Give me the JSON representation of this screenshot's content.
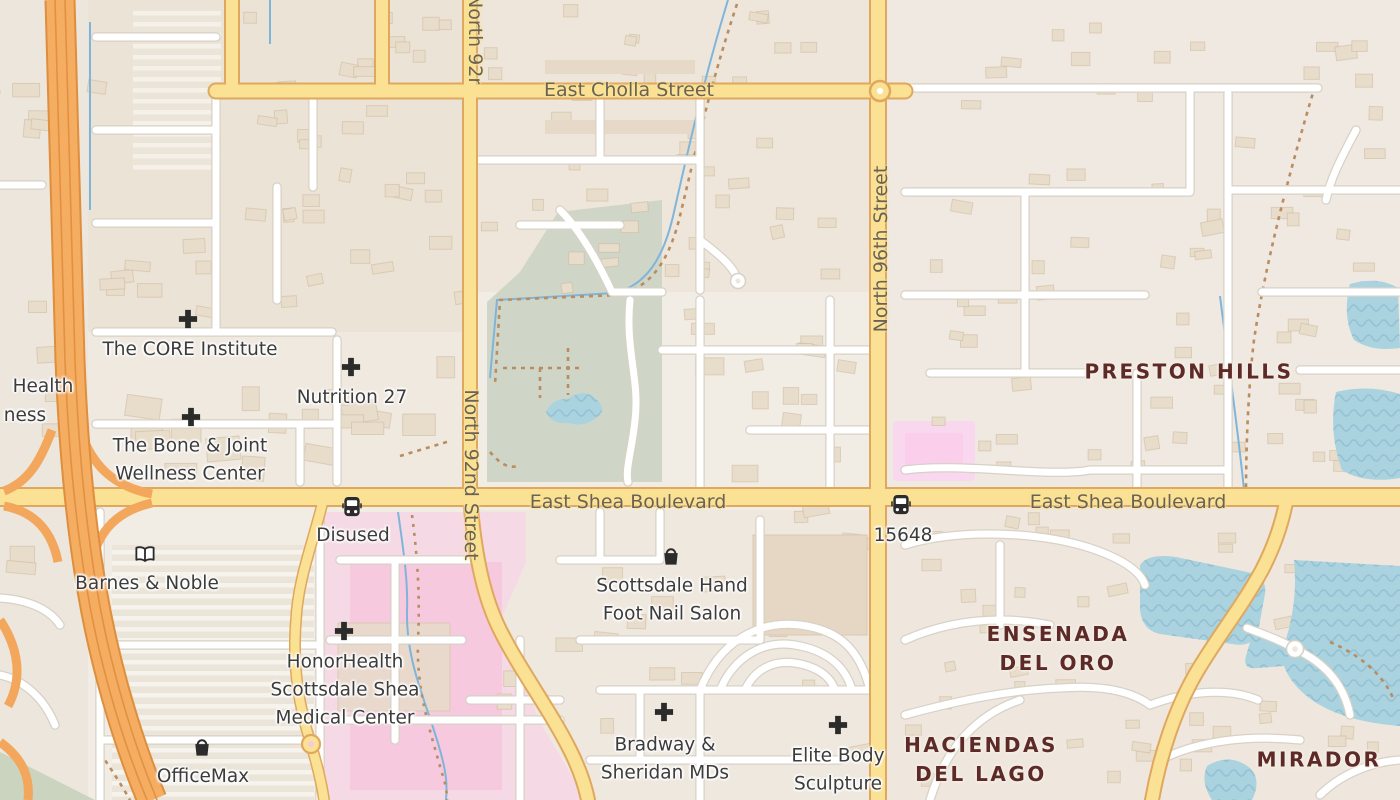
{
  "map": {
    "type": "street-map",
    "location": "Scottsdale, Arizona — Shea Boulevard area",
    "palette": {
      "land": "#f1ede5",
      "residential": "#ece4d8",
      "building": "#e8dccb",
      "road_white": "#ffffff",
      "road_white_casing": "#d7d1c6",
      "road_yellow": "#fae193",
      "road_yellow_casing": "#e0a85e",
      "motorway": "#f5ad62",
      "motorway_casing": "#de8e3c",
      "park": "#cfd6c8",
      "water": "#aad3df",
      "water_wave": "#8fbcd1",
      "hospital_pink": "#f5dae6",
      "hospital_pink_inner": "#f6c9de",
      "retail_pink": "#fbd2ee",
      "poi_label": "#3c3c3c",
      "road_label": "#6b6254",
      "area_label": "#5d2a27",
      "stream": "#7fb5da",
      "path_dashed": "#b98d5f",
      "icon": "#2b2b2b"
    },
    "road_labels": [
      {
        "text": "East Cholla Street",
        "x": 629,
        "y": 90,
        "dir": "h"
      },
      {
        "text": "East Shea Boulevard",
        "x": 628,
        "y": 502,
        "dir": "h"
      },
      {
        "text": "East Shea Boulevard",
        "x": 1128,
        "y": 502,
        "dir": "h"
      },
      {
        "text": "North 92nd Street",
        "x": 471,
        "y": 475,
        "dir": "v-down"
      },
      {
        "text": "North 92nd Street",
        "x": 452,
        "y": 0,
        "dir": "v-down",
        "clipped": true,
        "clip_w": 42,
        "clip_h": 84
      },
      {
        "text": "North 96th Street",
        "x": 881,
        "y": 249,
        "dir": "v-up"
      }
    ],
    "area_labels": [
      {
        "id": "preston-hills",
        "lines": [
          "PRESTON HILLS"
        ],
        "x": 1189,
        "y": 372
      },
      {
        "id": "ensenada-del-oro",
        "lines": [
          "ENSENADA",
          "DEL ORO"
        ],
        "x": 1058,
        "y": 649
      },
      {
        "id": "haciendas-del-lago",
        "lines": [
          "HACIENDAS",
          "DEL LAGO"
        ],
        "x": 981,
        "y": 760
      },
      {
        "id": "mirador",
        "lines": [
          "MIRADOR"
        ],
        "x": 1319,
        "y": 760
      }
    ],
    "pois": [
      {
        "id": "core-institute",
        "lines": [
          "The CORE Institute"
        ],
        "icon": "medical-cross-icon",
        "icon_x": 188,
        "icon_y": 319,
        "label_x": 190,
        "label_y": 350
      },
      {
        "id": "nutrition-27",
        "lines": [
          "Nutrition 27"
        ],
        "icon": "medical-cross-icon",
        "icon_x": 351,
        "icon_y": 367,
        "label_x": 352,
        "label_y": 398
      },
      {
        "id": "bone-joint-wellness",
        "lines": [
          "The Bone & Joint",
          "Wellness Center"
        ],
        "icon": "medical-cross-icon",
        "icon_x": 191,
        "icon_y": 417,
        "label_x": 190,
        "label_y": 460
      },
      {
        "id": "health-partial",
        "lines": [
          "Health"
        ],
        "icon": null,
        "label_x": 43,
        "label_y": 387
      },
      {
        "id": "ness-partial",
        "lines": [
          "ness"
        ],
        "icon": null,
        "label_x": 25,
        "label_y": 416
      },
      {
        "id": "barnes-noble",
        "lines": [
          "Barnes & Noble"
        ],
        "icon": "book-icon",
        "icon_x": 145,
        "icon_y": 554,
        "label_x": 147,
        "label_y": 584
      },
      {
        "id": "bus-stop-disused",
        "lines": [
          "Disused"
        ],
        "icon": "bus-icon",
        "icon_x": 352,
        "icon_y": 507,
        "label_x": 353,
        "label_y": 536
      },
      {
        "id": "bus-stop-15648",
        "lines": [
          "15648"
        ],
        "icon": "bus-icon",
        "icon_x": 901,
        "icon_y": 505,
        "label_x": 903,
        "label_y": 536
      },
      {
        "id": "scottsdale-nail-salon",
        "lines": [
          "Scottsdale Hand",
          "Foot Nail Salon"
        ],
        "icon": "shopping-bag-icon",
        "icon_x": 671,
        "icon_y": 556,
        "label_x": 672,
        "label_y": 600
      },
      {
        "id": "honorhealth-medical-center",
        "lines": [
          "HonorHealth",
          "Scottsdale Shea",
          "Medical Center"
        ],
        "icon": "medical-cross-icon",
        "icon_x": 344,
        "icon_y": 631,
        "label_x": 345,
        "label_y": 690
      },
      {
        "id": "officemax",
        "lines": [
          "OfficeMax"
        ],
        "icon": "shopping-bag-icon",
        "icon_x": 202,
        "icon_y": 747,
        "label_x": 203,
        "label_y": 777
      },
      {
        "id": "bradway-sheridan-mds",
        "lines": [
          "Bradway &",
          "Sheridan MDs"
        ],
        "icon": "medical-cross-icon",
        "icon_x": 664,
        "icon_y": 712,
        "label_x": 665,
        "label_y": 759
      },
      {
        "id": "elite-body-sculpture",
        "lines": [
          "Elite Body",
          "Sculpture"
        ],
        "icon": "medical-cross-icon",
        "icon_x": 838,
        "icon_y": 725,
        "label_x": 838,
        "label_y": 770
      }
    ]
  }
}
